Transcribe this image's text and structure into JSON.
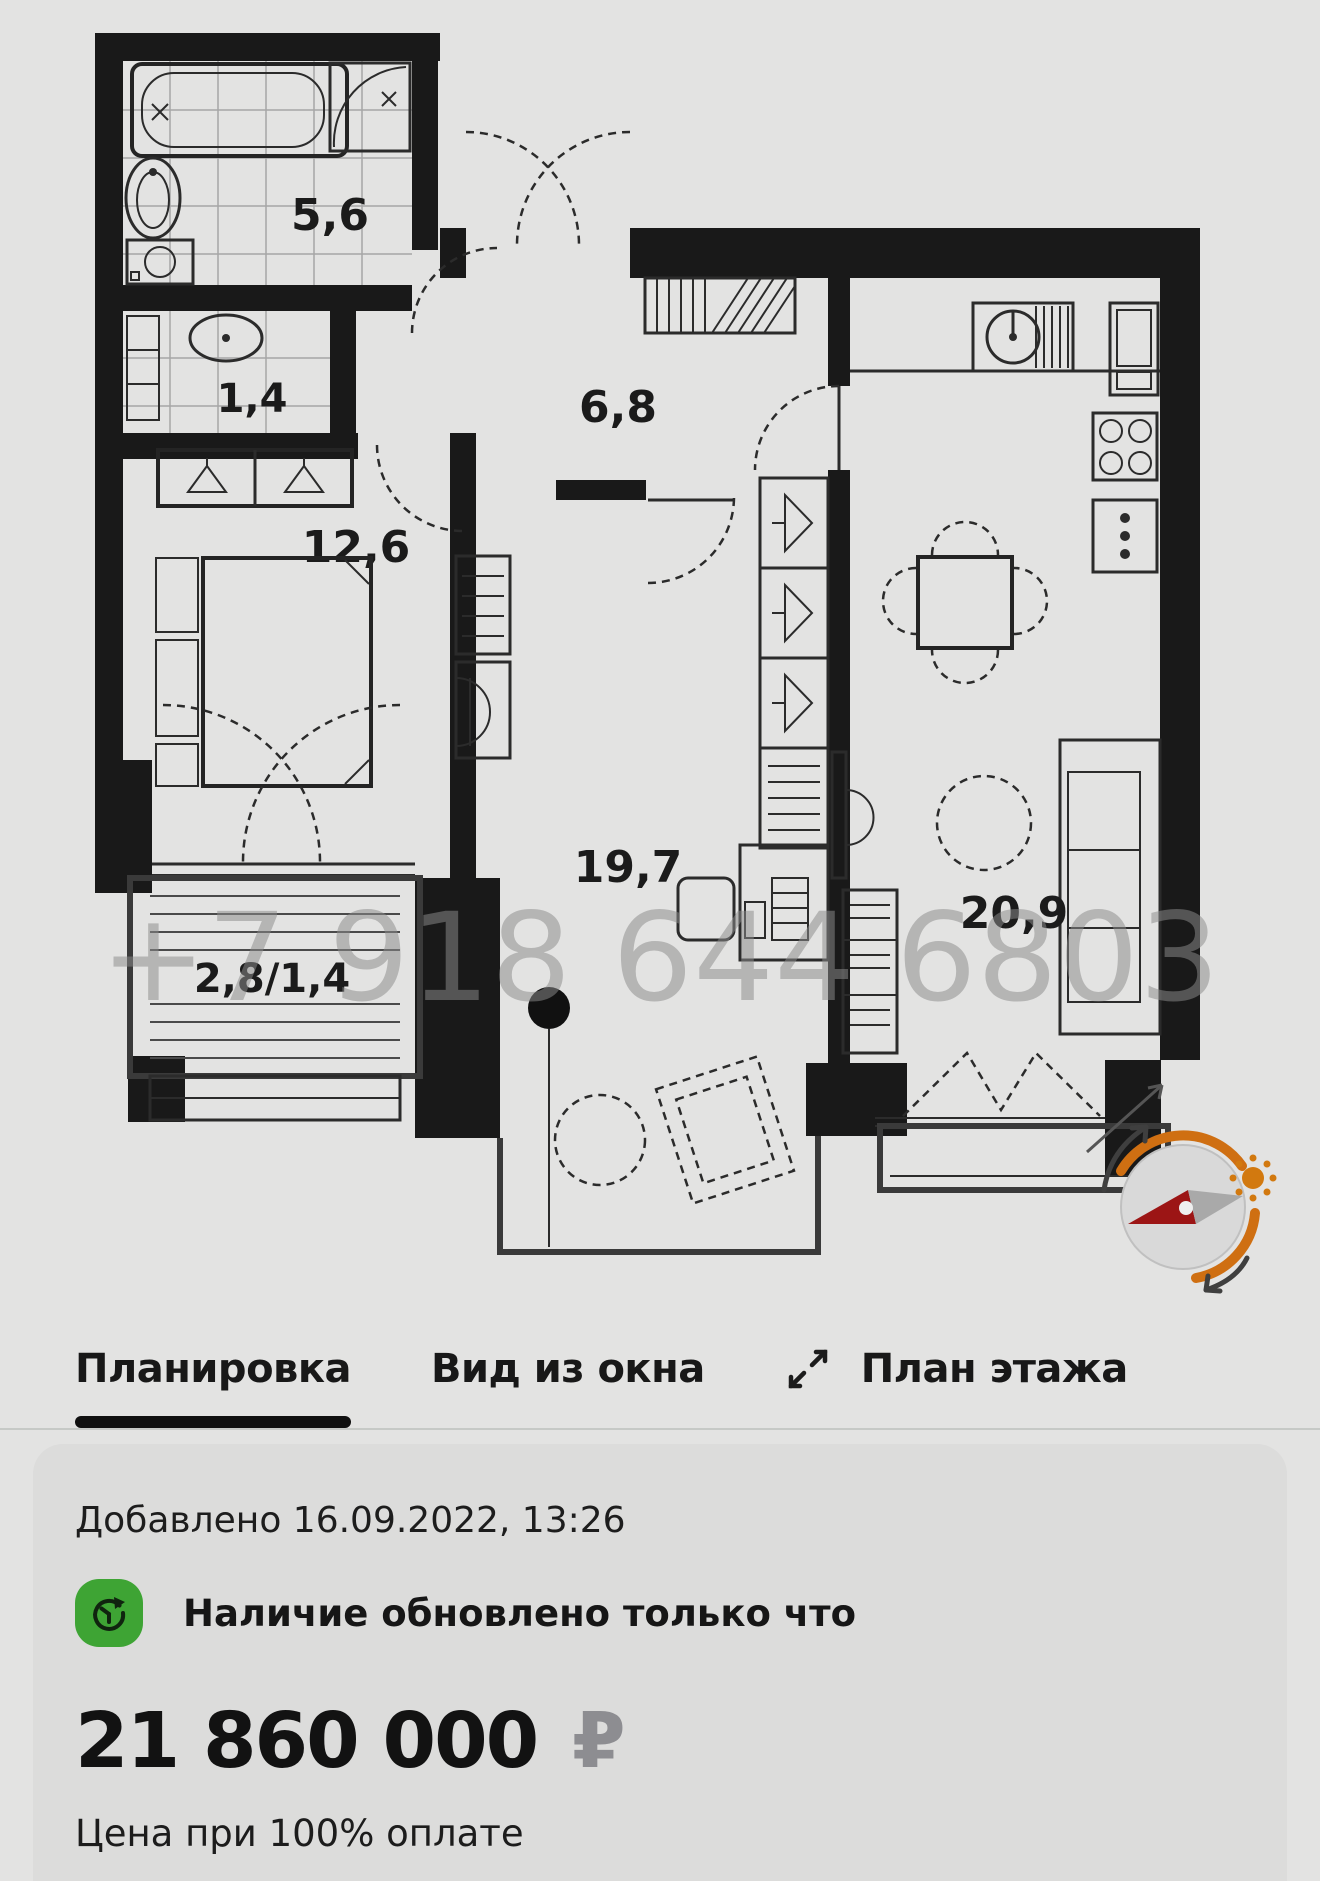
{
  "floor_plan": {
    "watermark": "+7 918 644 6803",
    "rooms": [
      {
        "name": "bathroom",
        "area": "5,6"
      },
      {
        "name": "toilet",
        "area": "1,4"
      },
      {
        "name": "hallway",
        "area": "6,8"
      },
      {
        "name": "bedroom",
        "area": "12,6"
      },
      {
        "name": "living-room",
        "area": "19,7"
      },
      {
        "name": "kitchen-living",
        "area": "20,9"
      },
      {
        "name": "balcony",
        "area": "2,8/1,4"
      }
    ],
    "colors": {
      "walls": "#191919",
      "compass_orange": "#cf6f12",
      "compass_red": "#9c1515"
    }
  },
  "tabs": [
    {
      "label": "Планировка",
      "active": true
    },
    {
      "label": "Вид из окна",
      "active": false
    },
    {
      "label": "План этажа",
      "active": false
    }
  ],
  "info_card": {
    "added": "Добавлено 16.09.2022, 13:26",
    "availability": "Наличие обновлено только что",
    "price": "21 860 000",
    "currency": "₽",
    "price_note": "Цена при 100% оплате",
    "accent_green": "#3ea434"
  }
}
